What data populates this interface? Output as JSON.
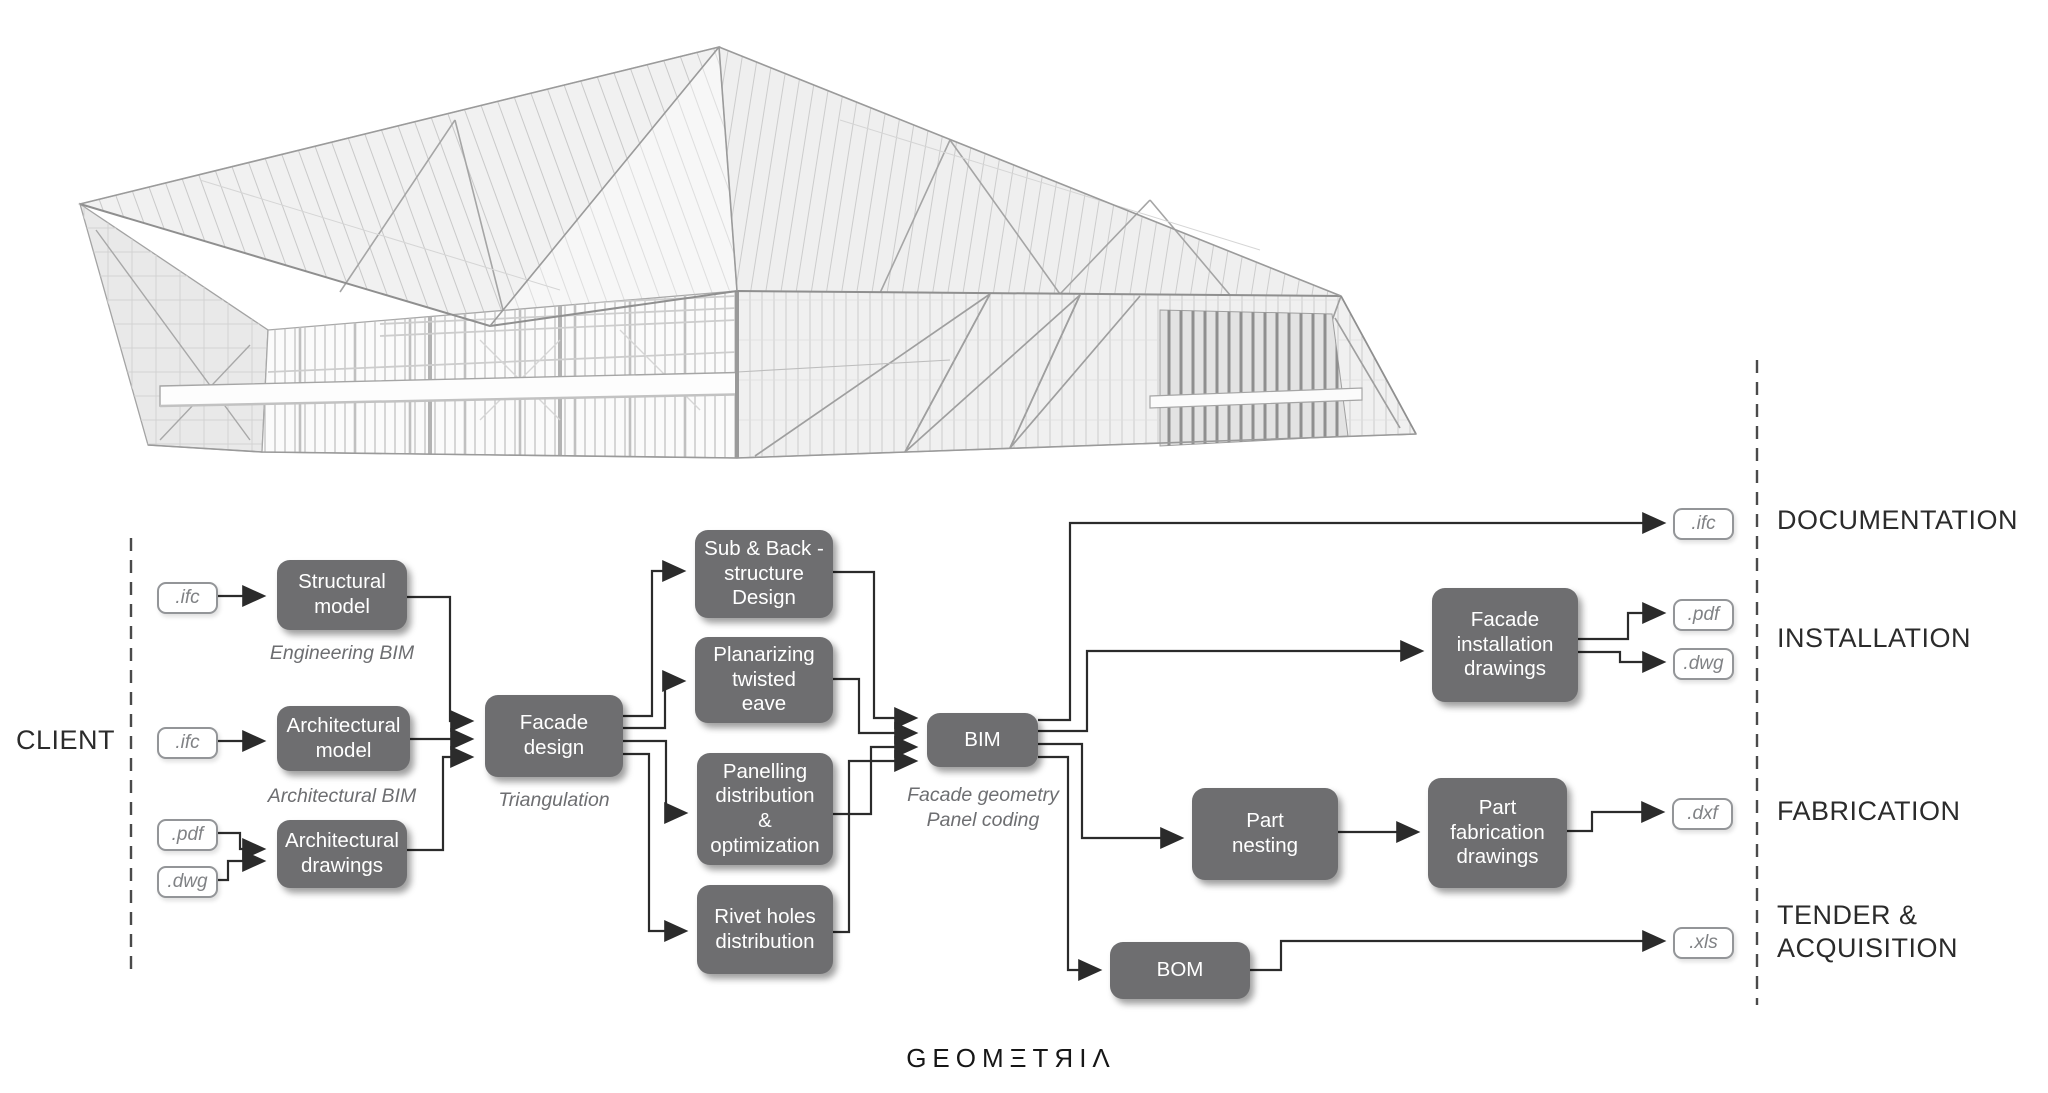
{
  "diagram": {
    "client_label": "CLIENT",
    "logo_text": "GEOMΞTЯIΛ",
    "sections": {
      "documentation": "DOCUMENTATION",
      "installation": "INSTALLATION",
      "fabrication": "FABRICATION",
      "tender": "TENDER &\nACQUISITION"
    },
    "nodes": {
      "structural_model": {
        "label": "Structural\nmodel",
        "caption": "Engineering BIM"
      },
      "architectural_model": {
        "label": "Architectural\nmodel",
        "caption": "Architectural BIM"
      },
      "architectural_drawings": {
        "label": "Architectural\ndrawings"
      },
      "facade_design": {
        "label": "Facade\ndesign",
        "caption": "Triangulation"
      },
      "sub_back_structure": {
        "label": "Sub & Back -\nstructure\nDesign"
      },
      "planarizing": {
        "label": "Planarizing\ntwisted\neave"
      },
      "panelling": {
        "label": "Panelling\ndistribution\n&\noptimization"
      },
      "rivet_holes": {
        "label": "Rivet holes\ndistribution"
      },
      "bim": {
        "label": "BIM",
        "caption": "Facade geometry\nPanel coding"
      },
      "facade_installation": {
        "label": "Facade\ninstallation\ndrawings"
      },
      "part_nesting": {
        "label": "Part\nnesting"
      },
      "part_fabrication": {
        "label": "Part\nfabrication\ndrawings"
      },
      "bom": {
        "label": "BOM"
      }
    },
    "chips": {
      "ifc_in_structural": ".ifc",
      "ifc_in_architectural": ".ifc",
      "pdf_in": ".pdf",
      "dwg_in": ".dwg",
      "ifc_out": ".ifc",
      "pdf_out": ".pdf",
      "dwg_out": ".dwg",
      "dxf_out": ".dxf",
      "xls_out": ".xls"
    }
  },
  "colors": {
    "node_fill": "#6e6e70",
    "node_text": "#ffffff",
    "connector": "#2b2b2b",
    "chip_border": "#939598",
    "chip_text": "#808285",
    "caption_text": "#6d6e71",
    "label_text": "#2b2b2b",
    "dashed_line": "#4a4a4a"
  }
}
